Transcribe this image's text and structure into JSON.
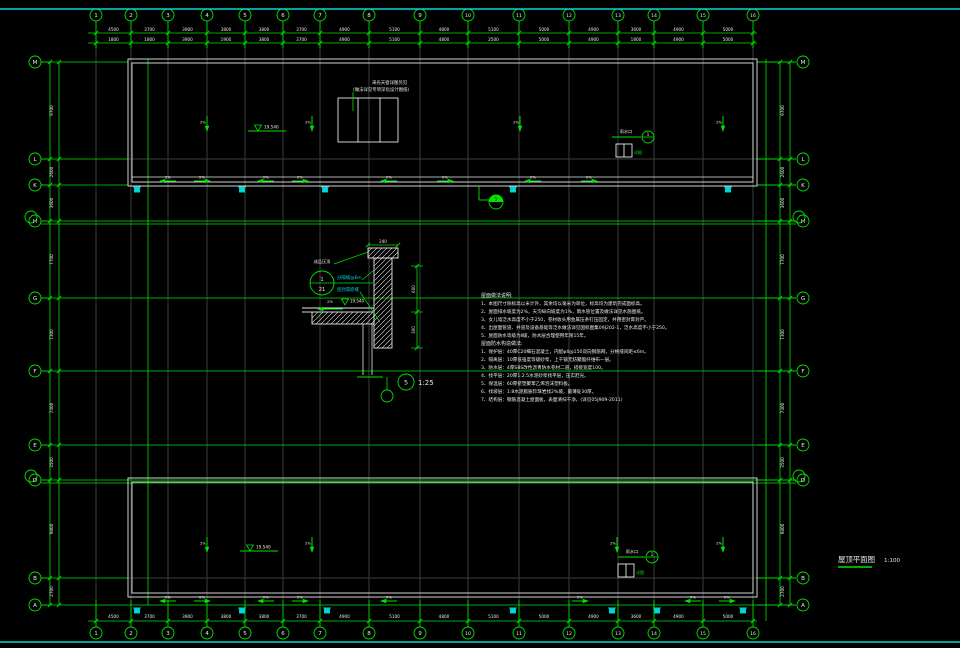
{
  "palette": {
    "green": "#00e400",
    "white": "#e8e8e8",
    "cyan": "#00d8d8",
    "gray": "#3c3c3c",
    "bg": "#000000"
  },
  "frame": {
    "top_y": 9,
    "bottom_y": 642
  },
  "title_block": {
    "title": "屋顶平面图",
    "scale": "1:100"
  },
  "grid": {
    "columns": {
      "labels": [
        "1",
        "2",
        "3",
        "4",
        "5",
        "6",
        "7",
        "8",
        "9",
        "10",
        "11",
        "12",
        "13",
        "14",
        "15",
        "16"
      ],
      "x": [
        96,
        131,
        168,
        207,
        245,
        283,
        320,
        369,
        420,
        468,
        519,
        569,
        618,
        654,
        703,
        753
      ],
      "top_y": 15,
      "bottom_y": 633
    },
    "rows": {
      "labels": [
        "M",
        "L",
        "K",
        "H",
        "G",
        "F",
        "E",
        "D",
        "B",
        "A"
      ],
      "y": [
        62,
        159,
        185,
        221,
        298,
        371,
        445,
        480,
        578,
        605
      ],
      "double": [
        false,
        false,
        false,
        true,
        false,
        false,
        false,
        true,
        false,
        false
      ],
      "full_span": [
        false,
        false,
        false,
        true,
        true,
        true,
        true,
        true,
        false,
        true
      ],
      "left_x": 35,
      "right_x": 803
    }
  },
  "dims": {
    "top_row1": {
      "y": 33,
      "values": [
        "4500",
        "3700",
        "3900",
        "3800",
        "3800",
        "3700",
        "4900",
        "5100",
        "4800",
        "5100",
        "5000",
        "4900",
        "3600",
        "4900",
        "5000"
      ]
    },
    "top_row2": {
      "y": 43,
      "values": [
        "1800",
        "1800",
        "3900",
        "1900",
        "3800",
        "3700",
        "4900",
        "5100",
        "4800",
        "2500",
        "5000",
        "4900",
        "1800",
        "4900",
        "5000"
      ]
    },
    "bottom": {
      "y": 621,
      "values": [
        "4500",
        "3700",
        "3900",
        "3800",
        "3800",
        "3700",
        "4900",
        "5100",
        "4800",
        "5100",
        "5000",
        "4900",
        "3600",
        "4900",
        "5000"
      ]
    },
    "left": {
      "values": [
        "9700",
        "2600",
        "3600",
        "7700",
        "7300",
        "7400",
        "3500",
        "9800",
        "2700"
      ]
    },
    "right": {
      "values": [
        "9700",
        "2600",
        "3600",
        "7700",
        "7300",
        "7400",
        "3500",
        "9800",
        "2700"
      ]
    }
  },
  "buildings": {
    "top": {
      "x1": 128,
      "y1": 59,
      "x2": 757,
      "y2": 186,
      "inset": 4,
      "extra_line_y": 177
    },
    "bottom": {
      "x1": 128,
      "y1": 478,
      "x2": 757,
      "y2": 597,
      "inset": 4
    }
  },
  "roof": {
    "skylight": {
      "x": 338,
      "y": 98,
      "w": 60,
      "h": 44,
      "dividers": [
        358,
        380
      ],
      "note_line1": "采光天窗详图另见",
      "note_line2": "(做法详见专项深化设计图纸)"
    },
    "slope_label": "2%",
    "gutter_arrows_top": {
      "y": 181,
      "xs": [
        160,
        210,
        258,
        308,
        381,
        453,
        525,
        597
      ]
    },
    "gutter_arrows_bottom": {
      "y": 601,
      "xs": [
        160,
        210,
        258,
        308,
        381,
        588,
        685,
        735
      ]
    },
    "fall_arrows_top": {
      "y1": 116,
      "y2": 131,
      "xs": [
        207,
        312,
        520,
        723
      ]
    },
    "fall_arrows_bottom": {
      "y1": 537,
      "y2": 552,
      "xs": [
        207,
        312,
        617,
        723
      ]
    },
    "elev_top": {
      "x": 258,
      "y": 131,
      "text": "19.540"
    },
    "elev_bottom": {
      "x": 250,
      "y": 551,
      "text": "19.540"
    },
    "drain_top": {
      "label": "雨水口",
      "ref": "1",
      "sub": "详图",
      "tx": 618,
      "ty": 133,
      "lx1": 612,
      "ly": 137,
      "lx2": 641,
      "cx": 648,
      "bx": 616,
      "by": 144
    },
    "drain_bottom": {
      "label": "雨水口",
      "ref": "1",
      "sub": "详图",
      "tx": 624,
      "ty": 553,
      "lx1": 618,
      "ly": 557,
      "lx2": 645,
      "cx": 652,
      "bx": 618,
      "by": 564
    },
    "downspouts_top": {
      "y": 187,
      "xs": [
        137,
        242,
        325,
        513,
        728
      ]
    },
    "downspouts_bottom": {
      "y": 608,
      "xs": [
        137,
        242,
        327,
        513,
        612,
        657,
        743
      ]
    },
    "section_cut": {
      "x": 496,
      "y": 202,
      "num": "5"
    }
  },
  "detail": {
    "cap": {
      "x": 368,
      "y": 248,
      "w": 30,
      "h": 10
    },
    "wall": {
      "x": 374,
      "y": 258,
      "w": 18,
      "h": 90
    },
    "slab": {
      "x": 312,
      "y": 312,
      "w": 62,
      "h": 12
    },
    "roofline_y": 308,
    "below_lines_x": [
      363,
      372
    ],
    "below_y1": 324,
    "below_y2": 375,
    "top_dim": {
      "text": "240",
      "y_line": 245
    },
    "right_dim": {
      "x": 417,
      "y1": 266,
      "mid": 312,
      "y2": 348,
      "labels": [
        "600",
        "300"
      ]
    },
    "slope": {
      "x1": 318,
      "x2": 343,
      "y": 309,
      "label": "2%"
    },
    "elev": {
      "text": "19.540",
      "x": 345,
      "y": 305
    },
    "cap_note": {
      "text": "成品压顶",
      "x": 322,
      "y": 263
    },
    "cyan_notes": [
      {
        "text": "分隔缝@6m",
        "x": 337,
        "y": 279
      },
      {
        "text": "密封膏嵌缝",
        "x": 337,
        "y": 291
      }
    ],
    "bubble": {
      "cx": 322,
      "cy": 283,
      "r": 12,
      "top": "1",
      "bottom": "21"
    },
    "title": {
      "num": "5",
      "cx": 406,
      "cy": 382,
      "r": 8,
      "scale": "1:25",
      "empty_cx": 387,
      "empty_cy": 396,
      "empty_r": 6
    }
  },
  "notes": {
    "x": 481,
    "start_y": 297,
    "line_h": 8,
    "header1": "屋面做法说明:",
    "items1": [
      "1、本图尺寸除标高以米计外，其余均以毫米为单位，标高均为建筑完成面标高。",
      "2、屋面排水坡度为2%，天沟纵向坡度为1%，雨水管位置及做法详见水施图纸。",
      "3、女儿墙泛水高度不小于250，卷材收头用金属压条钉压固定，并用密封膏封严。",
      "4、出屋面管道、井道及设备基础等泛水做法详见国标图集09J202-1，泛水高度不小于250。",
      "5、屋面防水等级为Ⅱ级，防水层合理使用年限15年。"
    ],
    "header2": "屋面防水构造做法:",
    "items2": [
      "1、保护层：40厚C20细石混凝土，内配φ4@150双向钢筋网，分格缝间距≤6m。",
      "2、隔离层：10厚低强度等级砂浆，上干铺无纺聚酯纤维布一层。",
      "3、防水层：4厚SBS改性沥青防水卷材二道，搭接宽度100。",
      "4、找平层：20厚1:2.5水泥砂浆找平层，压实赶光。",
      "5、保温层：60厚挤塑聚苯乙烯泡沫塑料板。",
      "6、找坡层：1:8水泥膨胀珍珠岩找2%坡，最薄处30厚。",
      "7、结构层：钢筋混凝土屋面板，表面清扫干净。(详见05J909-2011)"
    ]
  }
}
